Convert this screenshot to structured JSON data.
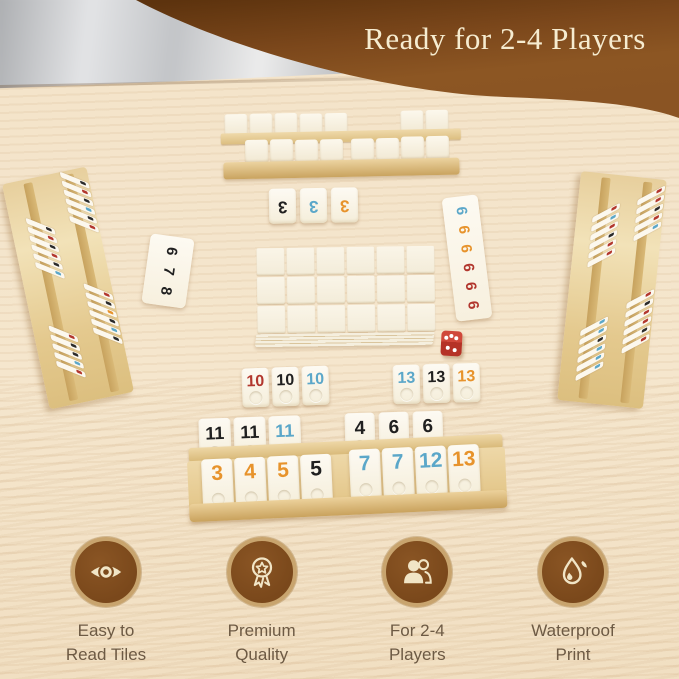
{
  "banner": {
    "title": "Ready for 2-4 Players",
    "bg_color": "#8a5423",
    "bg_dark_color": "#5d330e",
    "text_color": "#f6ecd0"
  },
  "palette": {
    "table_wood": "#f3e3c9",
    "rack_wood": "#ecd5a2",
    "tile_face": "#fbf7ec",
    "digit_black": "#202020",
    "digit_blue": "#5ba7c9",
    "digit_orange": "#e7932c",
    "digit_red": "#b2372e"
  },
  "tiles": {
    "top_set_3": {
      "values": [
        "3",
        "3",
        "3"
      ],
      "colors": [
        "black",
        "blue",
        "orange"
      ]
    },
    "left_run_678": {
      "values": [
        "6",
        "7",
        "8"
      ],
      "colors": [
        "black",
        "black",
        "black"
      ]
    },
    "right_run_6": {
      "values": [
        "6",
        "6",
        "6",
        "6",
        "6",
        "6"
      ],
      "colors": [
        "blue",
        "orange",
        "orange",
        "red",
        "red",
        "red"
      ]
    },
    "set_10": {
      "values": [
        "10",
        "10",
        "10"
      ],
      "colors": [
        "red",
        "black",
        "blue"
      ]
    },
    "set_13": {
      "values": [
        "13",
        "13",
        "13"
      ],
      "colors": [
        "blue",
        "black",
        "orange"
      ]
    },
    "set_11": {
      "values": [
        "11",
        "11",
        "11"
      ],
      "colors": [
        "black",
        "black",
        "blue"
      ]
    },
    "set_4_6_6": {
      "values": [
        "4",
        "6",
        "6"
      ],
      "colors": [
        "black",
        "black",
        "black"
      ]
    },
    "rack_run_left": {
      "values": [
        "3",
        "4",
        "5",
        "5"
      ],
      "colors": [
        "orange",
        "orange",
        "orange",
        "black"
      ]
    },
    "rack_run_right": {
      "values": [
        "7",
        "7",
        "12",
        "13"
      ],
      "colors": [
        "blue",
        "blue",
        "blue",
        "orange"
      ]
    }
  },
  "die": {
    "color": "#c63a2c",
    "top_face_pips": 3,
    "front_face_pips": 2
  },
  "features": [
    {
      "icon": "eye-icon",
      "lines": [
        "Easy to",
        "Read Tiles"
      ]
    },
    {
      "icon": "award-icon",
      "lines": [
        "Premium",
        "Quality"
      ]
    },
    {
      "icon": "players-icon",
      "lines": [
        "For 2-4",
        "Players"
      ]
    },
    {
      "icon": "droplet-icon",
      "lines": [
        "Waterproof",
        "Print"
      ]
    }
  ]
}
